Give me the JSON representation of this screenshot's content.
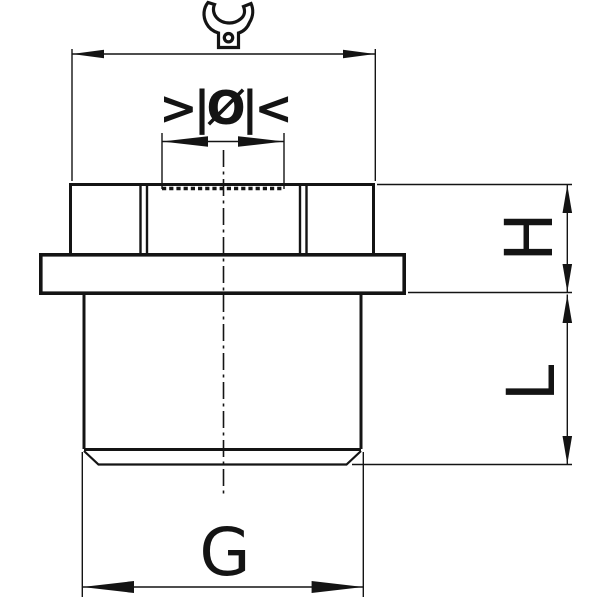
{
  "drawing": {
    "kind": "dimensional technical drawing of hex cable gland",
    "colors": {
      "ink": "#141414",
      "background": "#ffffff"
    },
    "icons": {
      "wrench": "open-end-wrench-icon",
      "clamp_range": "cable-diameter-range-icon"
    },
    "labels": {
      "clamp_range_symbol": ">|Ø|<",
      "height": "H",
      "length": "L",
      "thread_size": "G"
    }
  }
}
